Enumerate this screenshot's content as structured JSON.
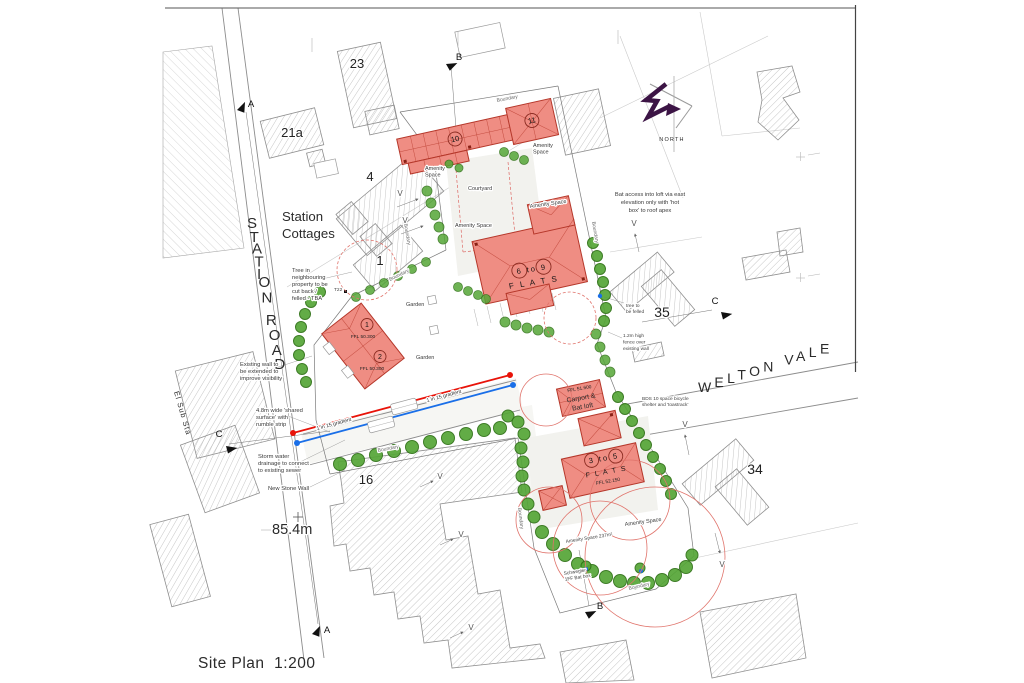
{
  "sheet": {
    "title": "Site Plan  1:200"
  },
  "roads": {
    "station_road": "STATION ROAD",
    "welton_vale": "WELTON VALE"
  },
  "places": {
    "station_cottages": [
      "Station",
      "Cottages"
    ],
    "el_sub_sta": "El Sub Sta",
    "north": "NORTH",
    "spot_height": "85.4m"
  },
  "plots": {
    "p23": "23",
    "p21a": "21a",
    "p4": "4",
    "p1": "1",
    "p16": "16",
    "p35": "35",
    "p34": "34"
  },
  "proposed": {
    "b10": "10",
    "b11": "11",
    "flats_6_9": {
      "range": "6 to 9",
      "word": "F L A T S"
    },
    "flats_3_5": {
      "range": "3 to 5",
      "word": "F L A T S",
      "ffl": "FFL 52.150"
    },
    "plot1": {
      "num": "1",
      "ffl": "FFL 50.300"
    },
    "plot2": {
      "num": "2",
      "ffl": "FFL 50.300"
    },
    "carport": {
      "ffl": "FFL 51.600",
      "name": [
        "Carport &",
        "Bat loft"
      ]
    }
  },
  "annotations": {
    "tree_neighbouring": [
      "Tree in",
      "neighbouring",
      "property to be",
      "cut back /",
      "felled - TBA"
    ],
    "existing_wall": [
      "Existing wall to",
      "be extended to",
      "improve visibility"
    ],
    "shared_surface": [
      "4.8m wide 'shared",
      "surface' with",
      "rumble strip"
    ],
    "storm_water": [
      "Storm water",
      "drainage to connect",
      "to existing sewer"
    ],
    "new_stone_wall": "New Stone Wall",
    "bat_access": [
      "Bat access into loft via east",
      "elevation only with 'hot",
      "box' to roof apex"
    ],
    "tree_felled": [
      "tree to",
      "be felled"
    ],
    "fence": [
      "1.2m high",
      "fence over",
      "existing wall"
    ],
    "bicycle": [
      "BDS 10 space bicycle",
      "shelter and 'toastrack'"
    ],
    "bat_box": [
      "Schwegler",
      "1FF Bat box"
    ],
    "amenity_237": "Amenity Space 237m²",
    "gradient": "1 in 15 gradient",
    "tree_tag": "T22"
  },
  "labels": {
    "boundary": "Boundary",
    "courtyard": "Courtyard",
    "garden": "Garden",
    "amenity_two_line": [
      "Amenity",
      "Space"
    ],
    "amenity": "Amenity Space",
    "v": "V"
  },
  "sections": {
    "a": "A",
    "b": "B",
    "c": "C"
  },
  "colors": {
    "proposed_fill": "#ef8d83",
    "proposed_stroke": "#b5372a",
    "tree_fill": "#55a637",
    "tree_stroke": "#2e7115",
    "gradient_red": "#e81309",
    "gradient_blue": "#1a6fe8",
    "protection_red": "#e0736b",
    "north_purple": "#3c1445"
  }
}
